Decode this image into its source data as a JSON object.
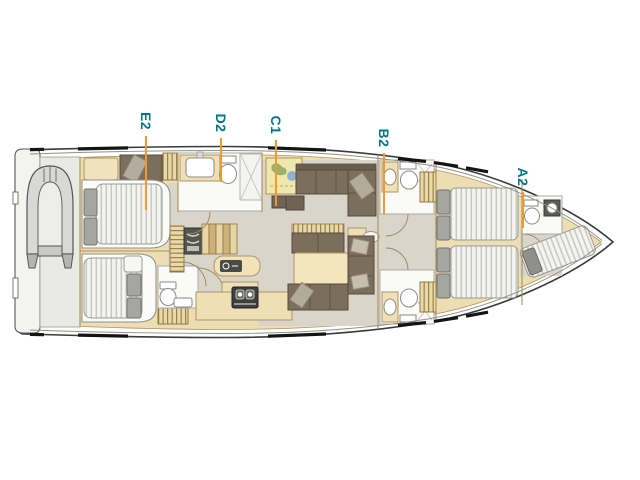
{
  "plan": {
    "name": "yacht-interior-floor-plan",
    "cabin_labels": [
      {
        "code": "E2"
      },
      {
        "code": "D2"
      },
      {
        "code": "C1"
      },
      {
        "code": "B2"
      },
      {
        "code": "A2"
      }
    ],
    "colors": {
      "label_text": "#00798b",
      "leader_line": "#f0992e",
      "hull_outline": "#3c3c3c",
      "cabinetry": "#ecddb3",
      "floor": "#d9d5cb",
      "upholstery": "#7b6e5b",
      "mattress": "#f4f4f1",
      "background": "#ffffff"
    }
  }
}
